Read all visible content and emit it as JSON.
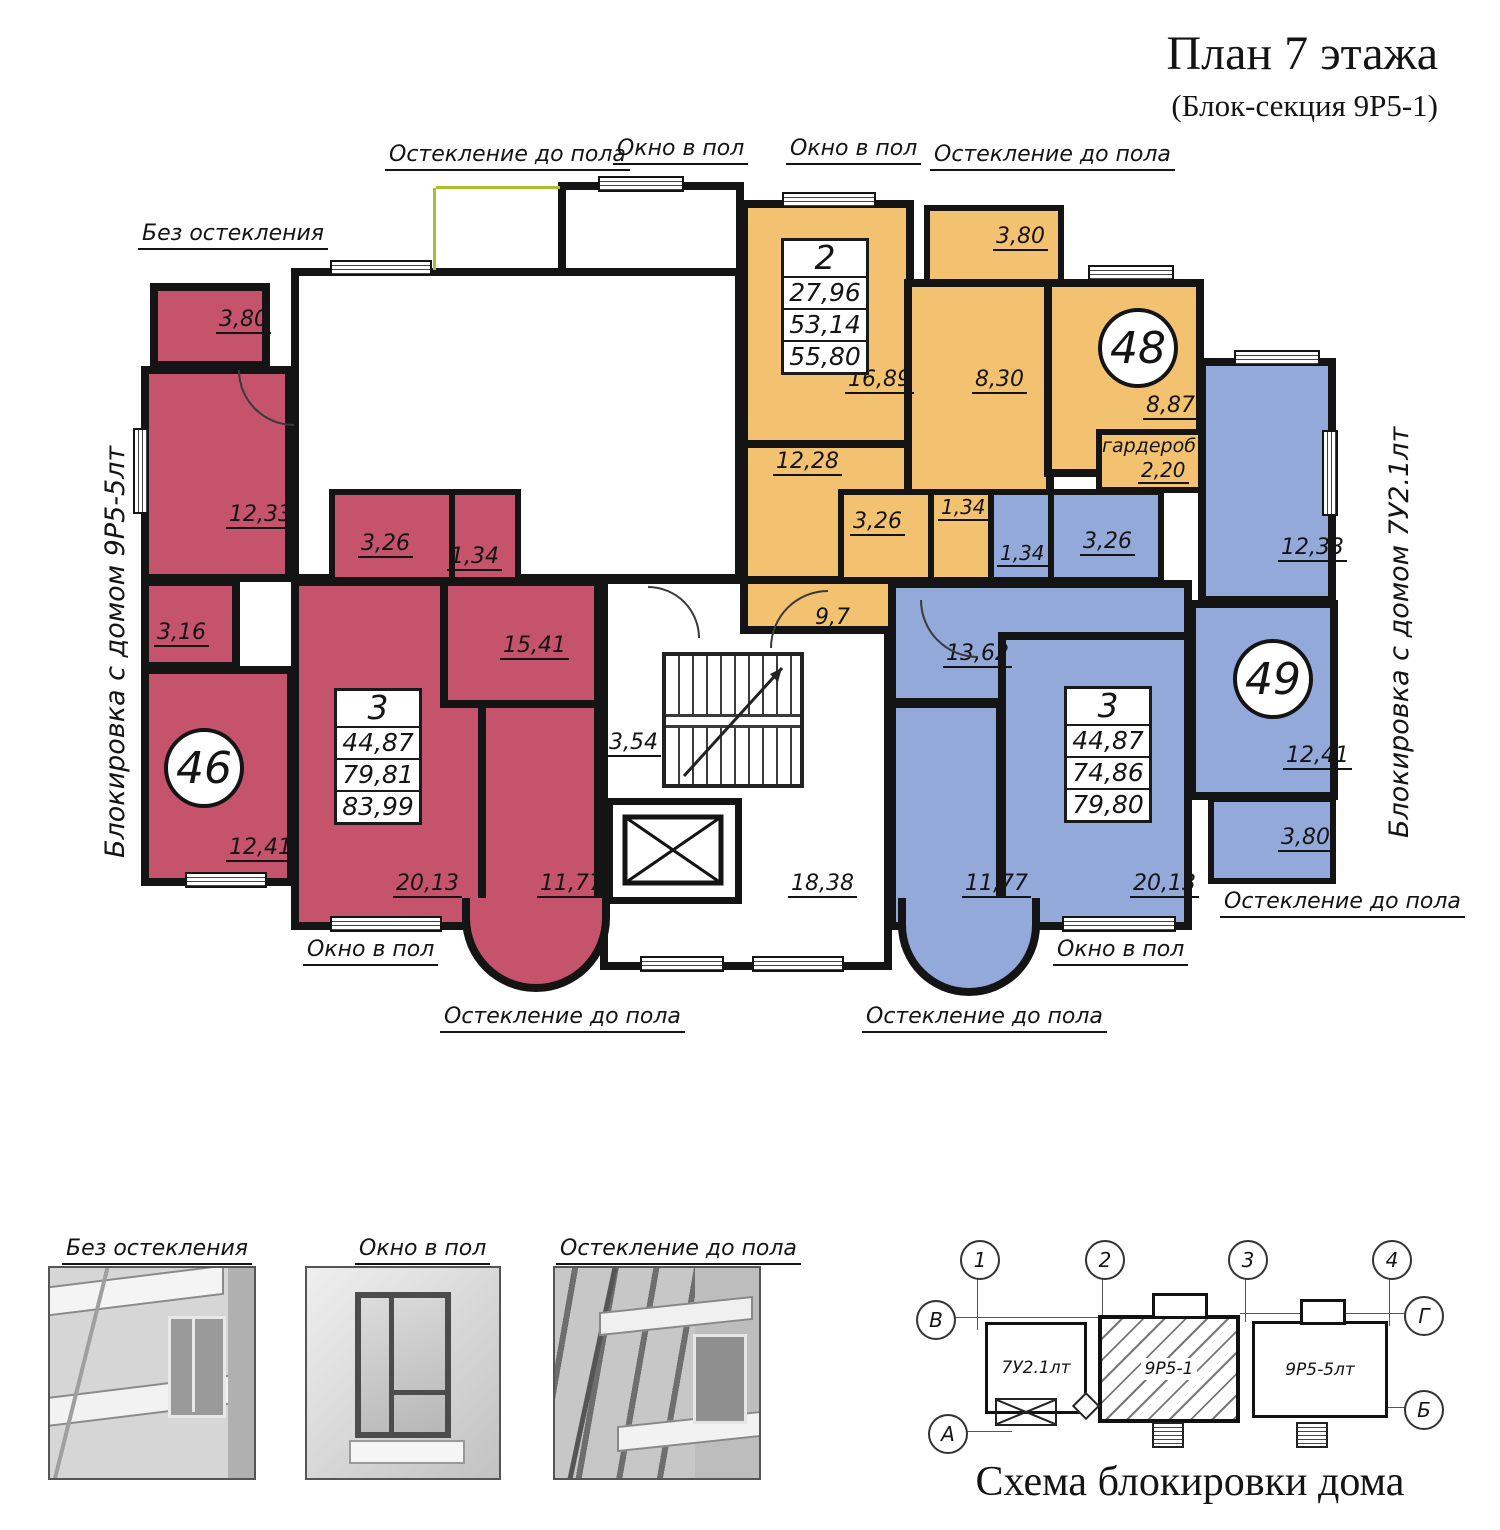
{
  "colors": {
    "red": "#c5536b",
    "orange": "#f3c271",
    "blue": "#93a9da",
    "wall": "#141414",
    "glazing": "#a9bf2f"
  },
  "header": {
    "title": "План 7 этажа",
    "subtitle": "(Блок-секция 9Р5-1)"
  },
  "side_labels": {
    "left": "Блокировка с домом 9Р5-5лт",
    "right": "Блокировка с домом 7У2.1лт"
  },
  "annotations": {
    "glazing_full": "Остекление до пола",
    "window_floor": "Окно в пол",
    "no_glazing": "Без остекления"
  },
  "common_areas": {
    "corridor": "9,7",
    "stairs": "3,54",
    "hall": "18,38"
  },
  "apartments": {
    "a46": {
      "number": "46",
      "table": {
        "rooms": "3",
        "living": "44,87",
        "area": "79,81",
        "total": "83,99"
      },
      "areas": {
        "balcony_top": "3,80",
        "bedroom1": "12,33",
        "storage": "3,16",
        "bedroom2": "12,41",
        "bath": "3,26",
        "wc": "1,34",
        "hall": "15,41",
        "living": "20,13",
        "kitchen": "11,77",
        "balcony_bottom": "3,25"
      }
    },
    "a48": {
      "number": "48",
      "table": {
        "rooms": "2",
        "living": "27,96",
        "area": "53,14",
        "total": "55,80"
      },
      "areas": {
        "living": "16,89",
        "kitchen": "8,30",
        "balcony": "3,80",
        "bedroom": "8,87",
        "wardrobe_label": "гардероб",
        "wardrobe": "2,20",
        "hall": "12,28",
        "bath": "3,26",
        "wc": "1,34"
      }
    },
    "a49": {
      "number": "49",
      "table": {
        "rooms": "3",
        "living": "44,87",
        "area": "74,86",
        "total": "79,80"
      },
      "areas": {
        "bedroom1": "12,33",
        "bedroom2": "12,41",
        "balcony_right": "3,80",
        "wc": "1,34",
        "bath": "3,26",
        "room_top": "13,62",
        "living": "20,13",
        "kitchen": "11,77",
        "balcony_bottom": "3,25"
      }
    }
  },
  "legend": {
    "items": [
      "Без остекления",
      "Окно в пол",
      "Остекление до пола"
    ]
  },
  "scheme": {
    "title": "Схема блокировки дома",
    "axis_numbers": [
      "1",
      "2",
      "3",
      "4"
    ],
    "axis_letters": [
      "В",
      "Г",
      "А",
      "Б"
    ],
    "blocks": [
      "7У2.1лт",
      "9Р5-1",
      "9Р5-5лт"
    ]
  }
}
